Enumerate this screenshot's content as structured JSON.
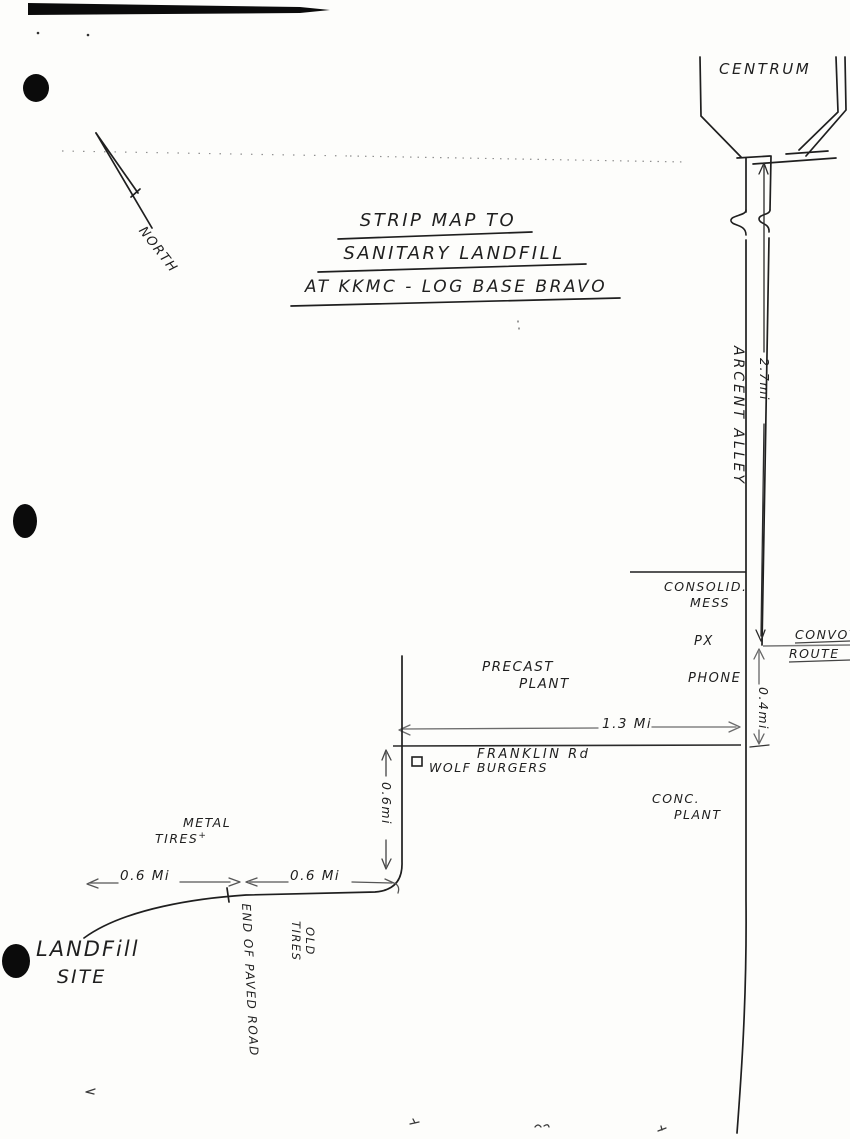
{
  "title": {
    "line1": "STRIP MAP TO",
    "line2": "SANITARY LANDFILL",
    "line3": "AT KKMC - LOG BASE BRAVO"
  },
  "compass": {
    "north_label": "NORTH"
  },
  "centrum": {
    "label": "CENTRUM"
  },
  "roads": {
    "arcent_alley": {
      "name": "ARCENT ALLEY",
      "distance": "2.7mi"
    },
    "franklin_rd": {
      "name": "FRANKLIN Rd",
      "distance": "1.3 Mi"
    },
    "convoy_route": {
      "line1": "CONVOY",
      "line2": "ROUTE"
    },
    "px_to_franklin_distance": "0.4mi",
    "connector_distance": "0.6mi",
    "west_leg": {
      "segment1": "0.6 Mi",
      "segment2": "0.6 Mi"
    },
    "end_of_paved_road": "END OF PAVED ROAD"
  },
  "landmarks": {
    "consolidated_mess": {
      "line1": "CONSOLID.",
      "line2": "MESS"
    },
    "px": "PX",
    "phone": "PHONE",
    "precast_plant": {
      "line1": "PRECAST",
      "line2": "PLANT"
    },
    "concrete_plant": {
      "line1": "CONC.",
      "line2": "PLANT"
    },
    "wolf_burgers": "WOLF BURGERS",
    "metal_tires": {
      "line1": "METAL",
      "line2": "TIRES",
      "cross_mark": "+"
    },
    "old_tires": {
      "line1": "OLD",
      "line2": "TIRES"
    },
    "landfill_site": {
      "line1": "LANDFill",
      "line2": "SITE"
    }
  },
  "colors": {
    "ink": "#1f1f1f",
    "faint_line": "#777777",
    "paper": "#fdfdfb"
  }
}
